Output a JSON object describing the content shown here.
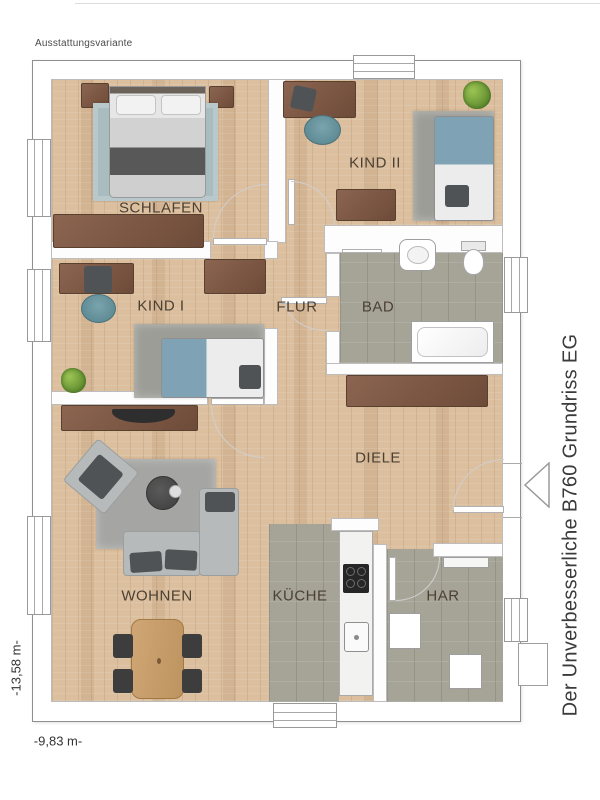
{
  "header": {
    "variant_label": "Ausstattungsvariante"
  },
  "title": {
    "text": "Der Unverbesserliche B760 Grundriss EG"
  },
  "dimensions": {
    "height": "-13,58 m-",
    "width": "-9,83 m-"
  },
  "rooms": {
    "schlafen": {
      "label": "SCHLAFEN"
    },
    "kind2": {
      "label": "KIND II"
    },
    "kind1": {
      "label": "KIND I"
    },
    "flur": {
      "label": "FLUR"
    },
    "bad": {
      "label": "BAD"
    },
    "diele": {
      "label": "DIELE"
    },
    "wohnen": {
      "label": "WOHNEN"
    },
    "kueche": {
      "label": "KÜCHE"
    },
    "har": {
      "label": "HAR"
    }
  },
  "colors": {
    "wood_floor": "#dcbf9e",
    "tile_floor": "#a5a497",
    "wall": "#ffffff",
    "furniture_brown": "#7d5a47",
    "chair_teal": "#6d98a2",
    "bed_blue": "#7fa3b5",
    "label_text": "#4c4034",
    "title_text": "#3b3b3b"
  }
}
